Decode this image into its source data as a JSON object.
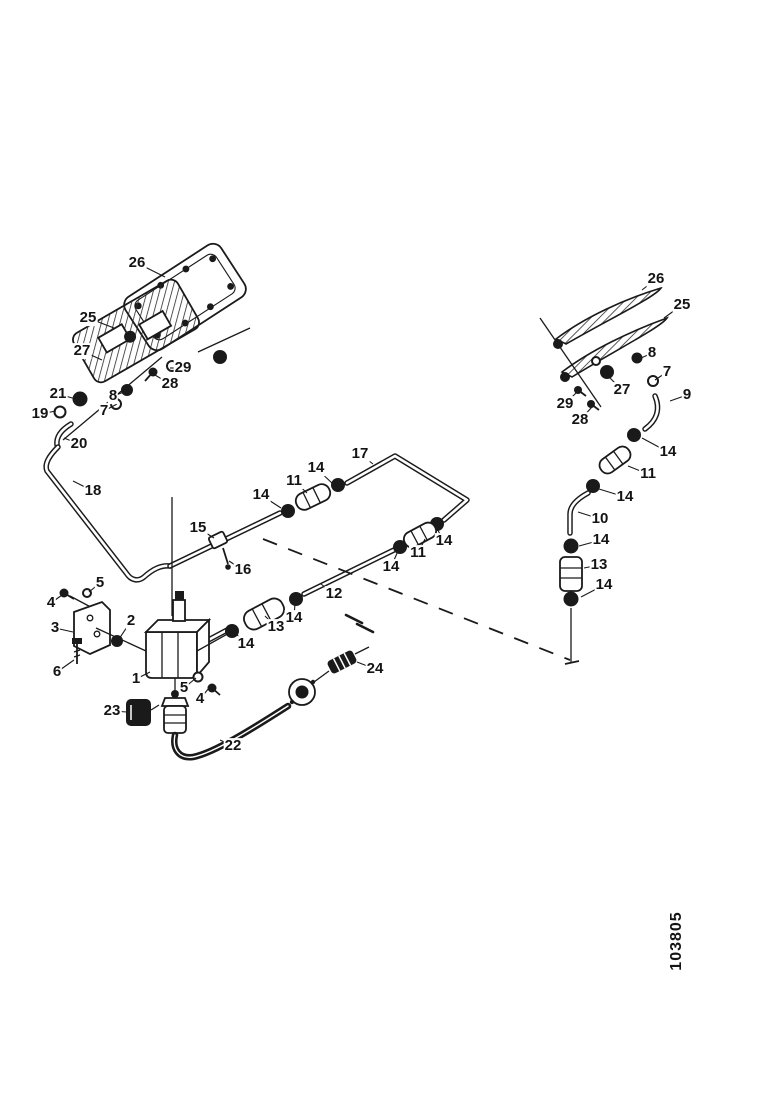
{
  "figure": {
    "part_number": "103805",
    "ink_color": "#1a1a1a",
    "background_color": "#ffffff"
  },
  "callouts": [
    {
      "n": "26",
      "x": 137,
      "y": 263,
      "tx": 165,
      "ty": 277
    },
    {
      "n": "25",
      "x": 88,
      "y": 318,
      "tx": 114,
      "ty": 328
    },
    {
      "n": "27",
      "x": 82,
      "y": 351,
      "tx": 102,
      "ty": 360
    },
    {
      "n": "29",
      "x": 183,
      "y": 368,
      "tx": 170,
      "ty": 368
    },
    {
      "n": "28",
      "x": 170,
      "y": 384,
      "tx": 155,
      "ty": 375
    },
    {
      "n": "8",
      "x": 113,
      "y": 396,
      "tx": 127,
      "ty": 391
    },
    {
      "n": "7",
      "x": 104,
      "y": 411,
      "tx": 117,
      "ty": 404
    },
    {
      "n": "21",
      "x": 58,
      "y": 394,
      "tx": 76,
      "ty": 399
    },
    {
      "n": "19",
      "x": 40,
      "y": 414,
      "tx": 56,
      "ty": 411
    },
    {
      "n": "20",
      "x": 79,
      "y": 444,
      "tx": 64,
      "ty": 438
    },
    {
      "n": "18",
      "x": 93,
      "y": 491,
      "tx": 73,
      "ty": 481
    },
    {
      "n": "17",
      "x": 360,
      "y": 454,
      "tx": 373,
      "ty": 464
    },
    {
      "n": "14",
      "x": 316,
      "y": 468,
      "tx": 333,
      "ty": 484
    },
    {
      "n": "11",
      "x": 294,
      "y": 481,
      "tx": 307,
      "ty": 493
    },
    {
      "n": "14",
      "x": 261,
      "y": 495,
      "tx": 281,
      "ty": 508
    },
    {
      "n": "15",
      "x": 198,
      "y": 528,
      "tx": 214,
      "ty": 538
    },
    {
      "n": "16",
      "x": 243,
      "y": 570,
      "tx": 229,
      "ty": 561
    },
    {
      "n": "14",
      "x": 444,
      "y": 541,
      "tx": 436,
      "ty": 527
    },
    {
      "n": "11",
      "x": 418,
      "y": 553,
      "tx": 425,
      "ty": 539
    },
    {
      "n": "14",
      "x": 391,
      "y": 567,
      "tx": 398,
      "ty": 551
    },
    {
      "n": "12",
      "x": 334,
      "y": 594,
      "tx": 321,
      "ty": 584
    },
    {
      "n": "14",
      "x": 294,
      "y": 618,
      "tx": 295,
      "ty": 603
    },
    {
      "n": "13",
      "x": 276,
      "y": 627,
      "tx": 265,
      "ty": 616
    },
    {
      "n": "14",
      "x": 246,
      "y": 644,
      "tx": 235,
      "ty": 633
    },
    {
      "n": "5",
      "x": 100,
      "y": 583,
      "tx": 89,
      "ty": 592
    },
    {
      "n": "4",
      "x": 51,
      "y": 603,
      "tx": 62,
      "ty": 595
    },
    {
      "n": "3",
      "x": 55,
      "y": 628,
      "tx": 73,
      "ty": 632
    },
    {
      "n": "2",
      "x": 131,
      "y": 621,
      "tx": 119,
      "ty": 639
    },
    {
      "n": "6",
      "x": 57,
      "y": 672,
      "tx": 74,
      "ty": 660
    },
    {
      "n": "1",
      "x": 136,
      "y": 679,
      "tx": 150,
      "ty": 672
    },
    {
      "n": "5",
      "x": 184,
      "y": 688,
      "tx": 196,
      "ty": 678
    },
    {
      "n": "4",
      "x": 200,
      "y": 699,
      "tx": 209,
      "ty": 688
    },
    {
      "n": "23",
      "x": 112,
      "y": 711,
      "tx": 127,
      "ty": 712
    },
    {
      "n": "22",
      "x": 233,
      "y": 746,
      "tx": 220,
      "ty": 740
    },
    {
      "n": "24",
      "x": 375,
      "y": 669,
      "tx": 357,
      "ty": 662
    },
    {
      "n": "26",
      "x": 656,
      "y": 279,
      "tx": 642,
      "ty": 290
    },
    {
      "n": "25",
      "x": 682,
      "y": 305,
      "tx": 664,
      "ty": 318
    },
    {
      "n": "8",
      "x": 652,
      "y": 353,
      "tx": 639,
      "ty": 359
    },
    {
      "n": "7",
      "x": 667,
      "y": 372,
      "tx": 655,
      "ty": 380
    },
    {
      "n": "27",
      "x": 622,
      "y": 390,
      "tx": 609,
      "ty": 377
    },
    {
      "n": "29",
      "x": 565,
      "y": 404,
      "tx": 577,
      "ty": 392
    },
    {
      "n": "28",
      "x": 580,
      "y": 420,
      "tx": 592,
      "ty": 407
    },
    {
      "n": "9",
      "x": 687,
      "y": 395,
      "tx": 670,
      "ty": 401
    },
    {
      "n": "14",
      "x": 668,
      "y": 452,
      "tx": 642,
      "ty": 438
    },
    {
      "n": "11",
      "x": 648,
      "y": 474,
      "tx": 628,
      "ty": 466
    },
    {
      "n": "14",
      "x": 625,
      "y": 497,
      "tx": 599,
      "ty": 489
    },
    {
      "n": "10",
      "x": 600,
      "y": 519,
      "tx": 578,
      "ty": 512
    },
    {
      "n": "14",
      "x": 601,
      "y": 540,
      "tx": 579,
      "ty": 546
    },
    {
      "n": "13",
      "x": 599,
      "y": 565,
      "tx": 584,
      "ty": 568
    },
    {
      "n": "14",
      "x": 604,
      "y": 585,
      "tx": 581,
      "ty": 597
    }
  ]
}
